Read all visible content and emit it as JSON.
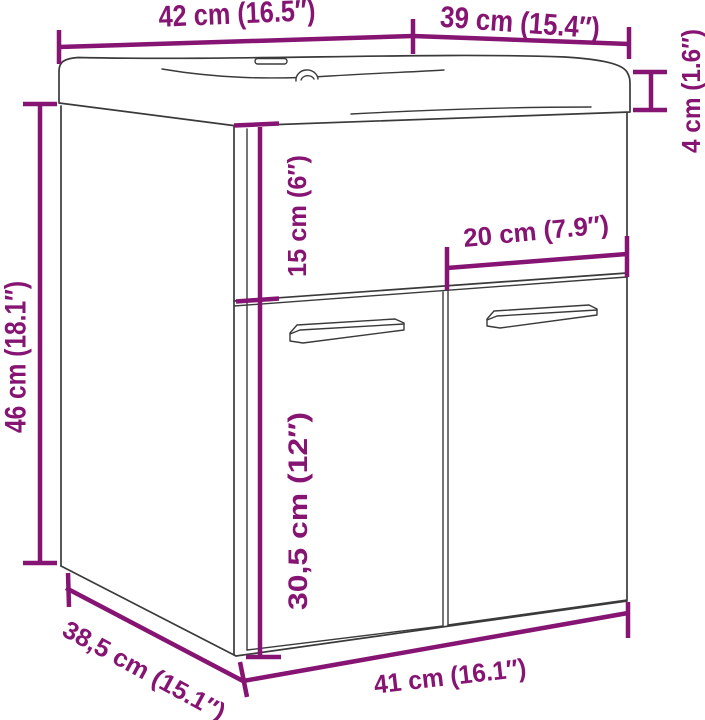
{
  "meta": {
    "subject": "line drawing of a wall-mounted bathroom cabinet with integrated sink, annotated with measurements"
  },
  "colors": {
    "annotation": "#861472",
    "drawing_line": "#3a3a3a",
    "background": "#ffffff"
  },
  "labels": {
    "top_width": "42 cm (16.5″)",
    "top_depth": "39 cm (15.4″)",
    "sink_thickness": "4 cm (1.6″)",
    "cabinet_height": "46 cm (18.1″)",
    "upper_panel_height": "15 cm (6″)",
    "door_width": "20 cm (7.9″)",
    "door_height": "30,5 cm (12″)",
    "bottom_depth": "38,5 cm (15.1″)",
    "bottom_width": "41 cm (16.1″)"
  }
}
